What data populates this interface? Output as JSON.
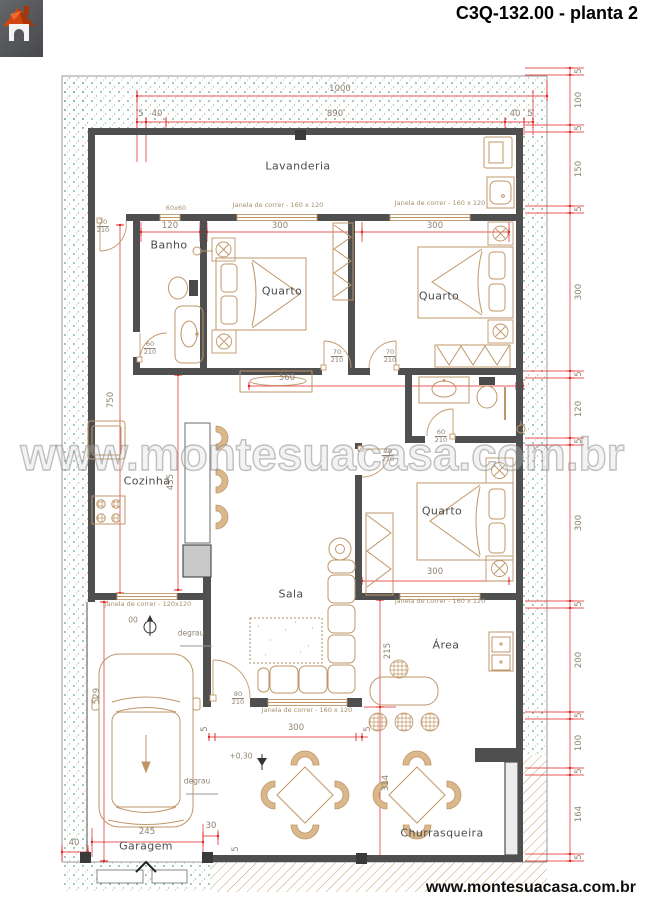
{
  "header": {
    "title": "C3Q-132.00 - planta 2"
  },
  "branding": {
    "watermark": "www.montesuacasa.com.br",
    "footer_site": "www.montesuacasa.com.br",
    "logo_name": "montesuacasa-house-logo"
  },
  "plan": {
    "room_labels": [
      {
        "label": "Lavanderia"
      },
      {
        "label": "Banho"
      },
      {
        "label": "Quarto"
      },
      {
        "label": "Quarto"
      },
      {
        "label": "Cozinha"
      },
      {
        "label": "Quarto"
      },
      {
        "label": "Sala"
      },
      {
        "label": "Área"
      },
      {
        "label": "Churrasqueira"
      },
      {
        "label": "Garagem"
      }
    ],
    "window_labels": [
      {
        "text": "60x60"
      },
      {
        "text": "Janela de correr - 160 x 120"
      },
      {
        "text": "Janela de correr - 160 x 120"
      },
      {
        "text": "janela de correr - 160 x 120"
      },
      {
        "text": "Janela de correr - 160 x 120"
      },
      {
        "text": "Janela de correr - 120x120"
      }
    ],
    "door_labels": [
      {
        "top": "70",
        "bottom": "210"
      },
      {
        "top": "60",
        "bottom": "210"
      },
      {
        "top": "70",
        "bottom": "210"
      },
      {
        "top": "70",
        "bottom": "210"
      },
      {
        "top": "60",
        "bottom": "210"
      },
      {
        "top": "70",
        "bottom": "210"
      },
      {
        "top": "80",
        "bottom": "210"
      }
    ],
    "dim_labels": [
      {
        "text": "1000"
      },
      {
        "text": "5"
      },
      {
        "text": "40"
      },
      {
        "text": "890"
      },
      {
        "text": "40"
      },
      {
        "text": "5"
      },
      {
        "text": "5"
      },
      {
        "text": "100"
      },
      {
        "text": "5"
      },
      {
        "text": "150"
      },
      {
        "text": "5"
      },
      {
        "text": "300"
      },
      {
        "text": "5"
      },
      {
        "text": "120"
      },
      {
        "text": "5"
      },
      {
        "text": "300"
      },
      {
        "text": "5"
      },
      {
        "text": "200"
      },
      {
        "text": "5"
      },
      {
        "text": "100"
      },
      {
        "text": "5"
      },
      {
        "text": "164"
      },
      {
        "text": "5"
      },
      {
        "text": "750"
      },
      {
        "text": "435"
      },
      {
        "text": "529"
      },
      {
        "text": "215"
      },
      {
        "text": "314"
      },
      {
        "text": "120"
      },
      {
        "text": "300"
      },
      {
        "text": "300"
      },
      {
        "text": "560"
      },
      {
        "text": "300"
      },
      {
        "text": "300"
      },
      {
        "text": "5"
      },
      {
        "text": "5"
      },
      {
        "text": "245"
      },
      {
        "text": "30"
      },
      {
        "text": "40"
      },
      {
        "text": "5"
      }
    ],
    "annotations": [
      {
        "text": "degrau"
      },
      {
        "text": "degrau"
      },
      {
        "text": "+0,30"
      },
      {
        "text": "00"
      }
    ],
    "colors": {
      "dimension_red": "#e02020",
      "wall_gray": "#4f4f4f",
      "furniture_tan": "#bf9668",
      "garden_green": "#5aa581",
      "hatch_tan": "#c8a274"
    }
  }
}
